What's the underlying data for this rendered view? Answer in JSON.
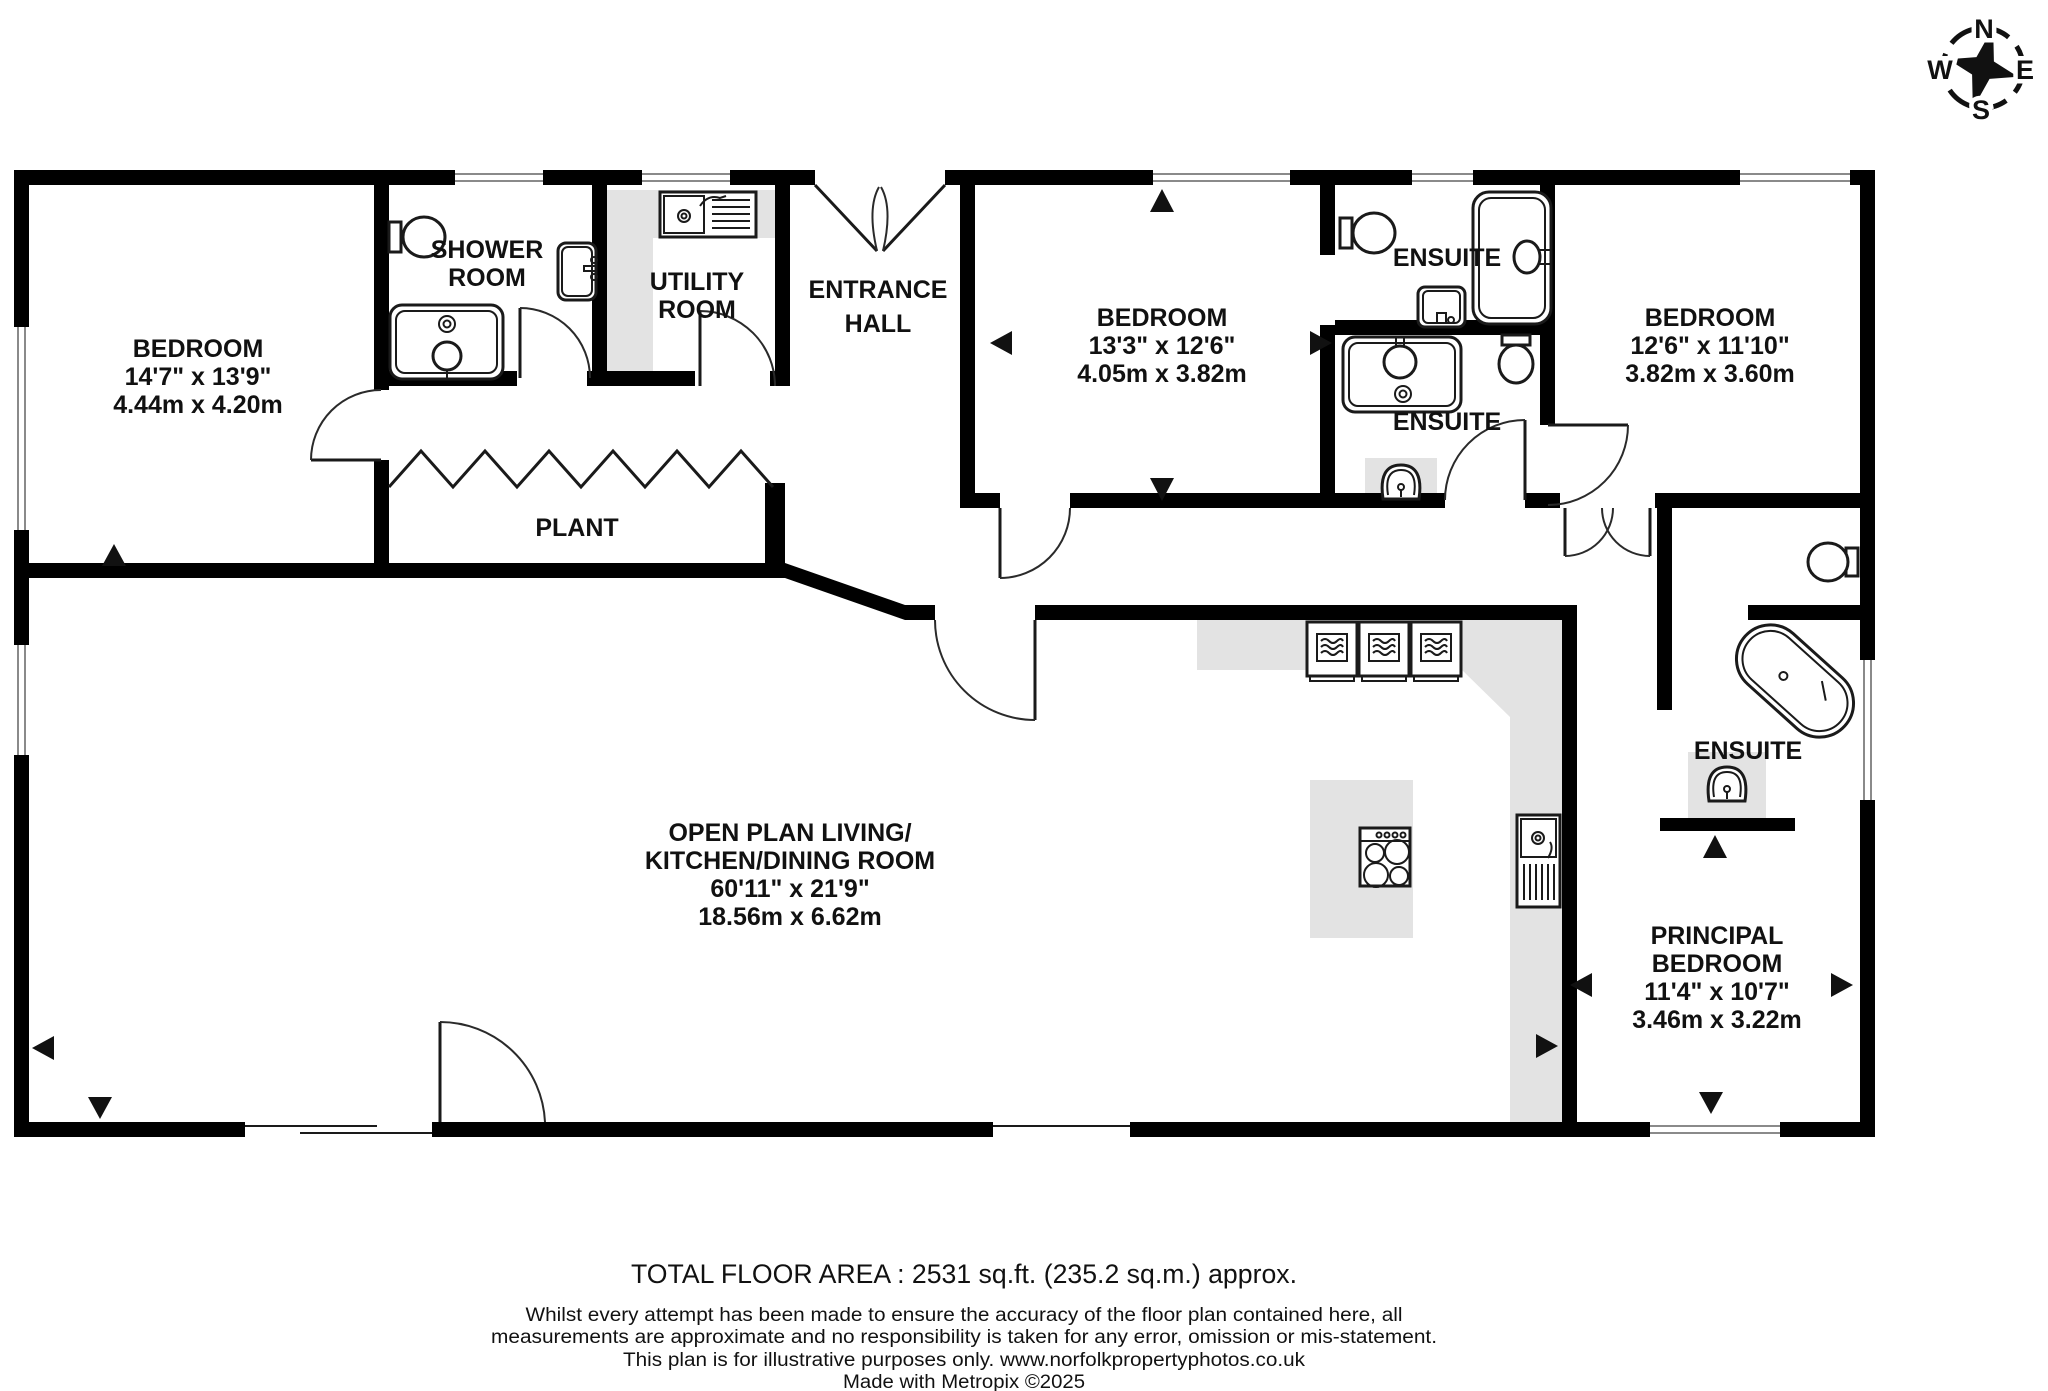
{
  "compass": {
    "north": "N",
    "east": "E",
    "south": "S",
    "west": "W"
  },
  "rooms": [
    {
      "id": "bedroom-left",
      "line1": "BEDROOM",
      "imperial": "14'7\"  x 13'9\"",
      "metric": "4.44m  x 4.20m"
    },
    {
      "id": "shower-room",
      "line1": "SHOWER",
      "line2": "ROOM"
    },
    {
      "id": "utility-room",
      "line1": "UTILITY",
      "line2": "ROOM"
    },
    {
      "id": "entrance-hall",
      "line1": "ENTRANCE",
      "line2": "HALL"
    },
    {
      "id": "bedroom-middle",
      "line1": "BEDROOM",
      "imperial": "13'3\"  x 12'6\"",
      "metric": "4.05m  x 3.82m"
    },
    {
      "id": "ensuite-upper",
      "line1": "ENSUITE"
    },
    {
      "id": "ensuite-lower",
      "line1": "ENSUITE"
    },
    {
      "id": "bedroom-right",
      "line1": "BEDROOM",
      "imperial": "12'6\"  x 11'10\"",
      "metric": "3.82m  x 3.60m"
    },
    {
      "id": "plant",
      "line1": "PLANT"
    },
    {
      "id": "open-plan",
      "line1": "OPEN PLAN LIVING/",
      "line2": "KITCHEN/DINING ROOM",
      "imperial": "60'11\"  x 21'9\"",
      "metric": "18.56m  x 6.62m"
    },
    {
      "id": "ensuite-principal",
      "line1": "ENSUITE"
    },
    {
      "id": "principal-bedroom",
      "line1": "PRINCIPAL",
      "line2": "BEDROOM",
      "imperial": "11'4\"  x 10'7\"",
      "metric": "3.46m  x 3.22m"
    }
  ],
  "footer": {
    "total_area": "TOTAL FLOOR AREA : 2531 sq.ft. (235.2 sq.m.) approx.",
    "disclaimer_line1": "Whilst every attempt has been made to ensure the accuracy of the floor plan contained here, all",
    "disclaimer_line2": "measurements are approximate and no responsibility is taken for any error, omission or mis-statement.",
    "disclaimer_line3": "This plan is for illustrative purposes only. www.norfolkpropertyphotos.co.uk",
    "disclaimer_line4": "Made with Metropix ©2025"
  },
  "colors": {
    "wall": "#000000",
    "counter": "#e3e3e3",
    "text": "#111111",
    "background": "#ffffff"
  }
}
